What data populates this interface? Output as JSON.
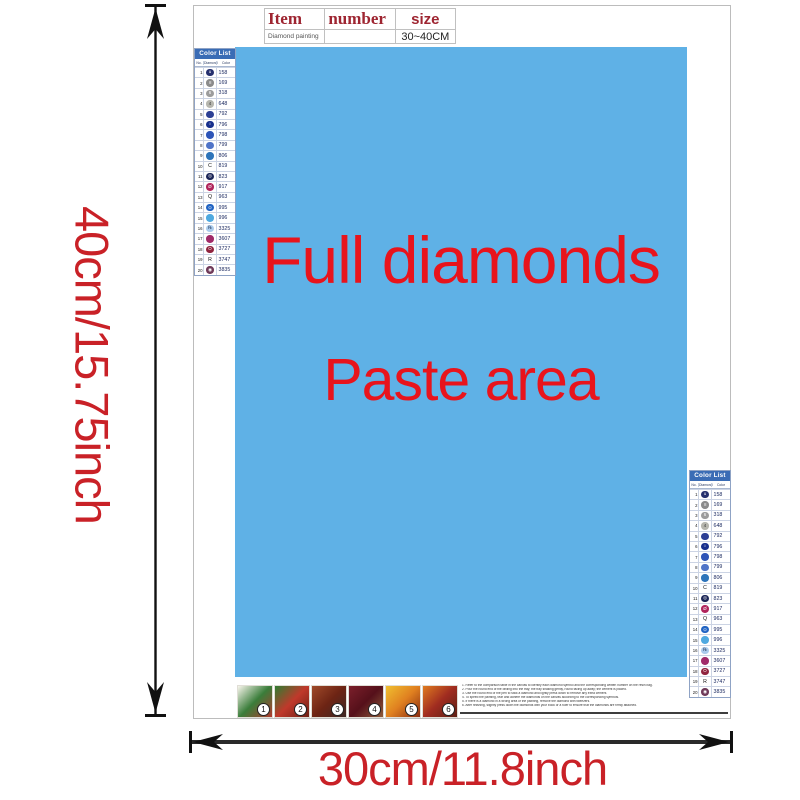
{
  "item_table": {
    "item_label": "Item",
    "number_label": "number",
    "size_label": "size",
    "product_name": "Diamond painting",
    "size_value": "30~40CM"
  },
  "paste_area": {
    "line1": "Full diamonds",
    "line2": "Paste area"
  },
  "dimensions": {
    "height_label": "40cm/15.75inch",
    "width_label": "30cm/11.8inch"
  },
  "colors": {
    "paste_blue": "#5fb1e6",
    "text_red": "#e8141c",
    "dim_red": "#c92127",
    "list_header_blue": "#3a6cb5"
  },
  "color_list": {
    "title": "Color List",
    "col_no": "No.",
    "col_diamond": "Diamond",
    "col_color": "Color",
    "rows": [
      {
        "no": "1",
        "type": "circle",
        "glyph": "u",
        "fill": "#26306e",
        "glyph_color": "#ffffff",
        "code": "158"
      },
      {
        "no": "2",
        "type": "circle",
        "glyph": "≡",
        "fill": "#8b8b8b",
        "glyph_color": "#ffffff",
        "code": "169"
      },
      {
        "no": "3",
        "type": "circle",
        "glyph": "6",
        "fill": "#9c9c9c",
        "glyph_color": "#ffffff",
        "code": "318"
      },
      {
        "no": "4",
        "type": "circle",
        "glyph": "4",
        "fill": "#b6b6ae",
        "glyph_color": "#333333",
        "code": "648"
      },
      {
        "no": "5",
        "type": "circle",
        "glyph": "",
        "fill": "#2c3f95",
        "glyph_color": "#ffffff",
        "code": "792"
      },
      {
        "no": "6",
        "type": "circle",
        "glyph": "○",
        "fill": "#172f8d",
        "glyph_color": "#ffffff",
        "code": "796"
      },
      {
        "no": "7",
        "type": "circle",
        "glyph": "",
        "fill": "#2e55b8",
        "glyph_color": "#ffffff",
        "code": "798"
      },
      {
        "no": "8",
        "type": "circle",
        "glyph": "",
        "fill": "#4f74c8",
        "glyph_color": "#ffffff",
        "code": "799"
      },
      {
        "no": "9",
        "type": "circle",
        "glyph": "",
        "fill": "#2d74ba",
        "glyph_color": "#ffffff",
        "code": "806"
      },
      {
        "no": "10",
        "type": "text",
        "glyph": "C",
        "fill": "",
        "glyph_color": "#111111",
        "code": "819"
      },
      {
        "no": "11",
        "type": "circle",
        "glyph": "◎",
        "fill": "#1b2557",
        "glyph_color": "#ffffff",
        "code": "823"
      },
      {
        "no": "12",
        "type": "circle",
        "glyph": "Ø",
        "fill": "#b0255c",
        "glyph_color": "#ffffff",
        "code": "917"
      },
      {
        "no": "13",
        "type": "text",
        "glyph": "Q",
        "fill": "",
        "glyph_color": "#111111",
        "code": "963"
      },
      {
        "no": "14",
        "type": "circle",
        "glyph": "⊙",
        "fill": "#2063c3",
        "glyph_color": "#ffffff",
        "code": "995"
      },
      {
        "no": "15",
        "type": "circle",
        "glyph": "",
        "fill": "#4fa9e0",
        "glyph_color": "#ffffff",
        "code": "996"
      },
      {
        "no": "16",
        "type": "circle",
        "glyph": "℞",
        "fill": "#aacbec",
        "glyph_color": "#223355",
        "code": "3325"
      },
      {
        "no": "17",
        "type": "circle",
        "glyph": "",
        "fill": "#a02a69",
        "glyph_color": "#ffffff",
        "code": "3607"
      },
      {
        "no": "18",
        "type": "circle",
        "glyph": "O",
        "fill": "#90243f",
        "glyph_color": "#ffffff",
        "code": "3727"
      },
      {
        "no": "19",
        "type": "text",
        "glyph": "R",
        "fill": "",
        "glyph_color": "#111111",
        "code": "3747"
      },
      {
        "no": "20",
        "type": "circle",
        "glyph": "◉",
        "fill": "#6f3a59",
        "glyph_color": "#ffffff",
        "code": "3835"
      }
    ]
  },
  "steps": {
    "items": [
      {
        "num": "1",
        "colors": [
          "#f8f5ec",
          "#3a7d3a",
          "#b03a2e"
        ]
      },
      {
        "num": "2",
        "colors": [
          "#2e7d32",
          "#c0392b",
          "#6d1f14"
        ]
      },
      {
        "num": "3",
        "colors": [
          "#a04a2a",
          "#6d2414",
          "#3e2723"
        ]
      },
      {
        "num": "4",
        "colors": [
          "#7b1f2b",
          "#55101a",
          "#8e5b3a"
        ]
      },
      {
        "num": "5",
        "colors": [
          "#f0c030",
          "#e08020",
          "#8a2c10"
        ]
      },
      {
        "num": "6",
        "colors": [
          "#e07b20",
          "#a02c20",
          "#5d1f14"
        ]
      }
    ]
  },
  "instructions": {
    "lines": [
      "1. Refer to the comparison table in the canvas to identify each diamond symbol and the corresponding written number on the resin bag.",
      "2. Pour the round end of the drilling into the tray; the tray shaking gently, round facing up away; the cement is placed.",
      "3. Use the round end of the pen to stick a diamond and lightly press down to remove any extra cement.",
      "4. To speed the painting, tear and adhere the diamonds on the canvas according to the corresponding symbols.",
      "5. If there is a diamond in a wrong area of the painting, remove the diamond with tweezers.",
      "6. After finishing, slightly press down the diamonds with your book or a ruler to ensure that the diamonds are firmly attached."
    ]
  }
}
